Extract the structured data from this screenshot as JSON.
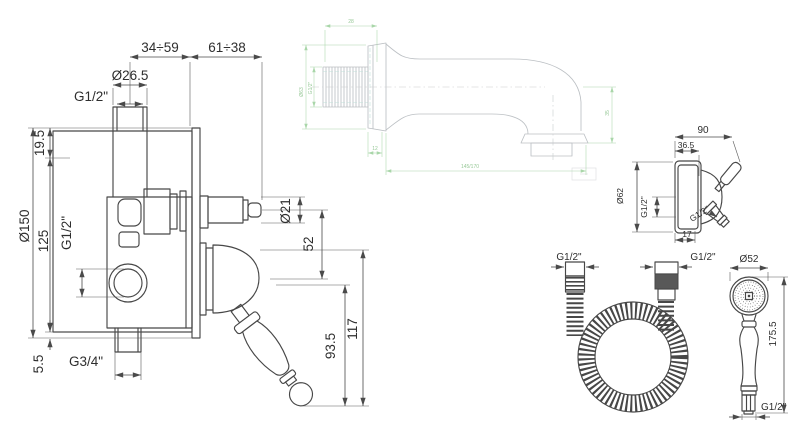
{
  "drawing": {
    "type": "technical-dimension-drawing",
    "subject": "concealed shower mixer set with wall spout, bracket, hose and handshower"
  },
  "colors": {
    "line": "#474747",
    "dimension": "#4a4a4a",
    "spout_line": "#bcc0c4",
    "spout_dim_green": "#a9d6a9",
    "hose_band": "#585858",
    "background": "#ffffff"
  },
  "mixer": {
    "span_left": "34÷59",
    "span_right": "61÷38",
    "top_pipe_od": "Ø26.5",
    "top_thread": "G1/2\"",
    "offset_top": "19.5",
    "plate_diameter": "Ø150",
    "body_height": "125",
    "plate_offset": "5.5",
    "side_port_thread": "G1/2\"",
    "bottom_port_thread": "G3/4\"",
    "spindle_diameter": "Ø21",
    "axis_spacing": "52",
    "handle_length": "93.5",
    "handle_drop": "117"
  },
  "spout": {
    "thread_length": "28",
    "flange_diameter": "Ø63",
    "thread": "G1/2\"",
    "flange_depth": "12",
    "projection": "145/170",
    "outlet_drop": "35"
  },
  "bracket": {
    "width": "90",
    "ball_offset": "36.5",
    "flange_diameter": "Ø62",
    "inlet_thread": "G1/2\"",
    "outlet_thread": "G1/2\"",
    "outlet_spacing": "17"
  },
  "hose": {
    "left_thread": "G1/2\"",
    "right_thread": "G1/2\""
  },
  "handshower": {
    "head_diameter": "Ø52",
    "length": "175.5",
    "thread": "G1/2\""
  }
}
